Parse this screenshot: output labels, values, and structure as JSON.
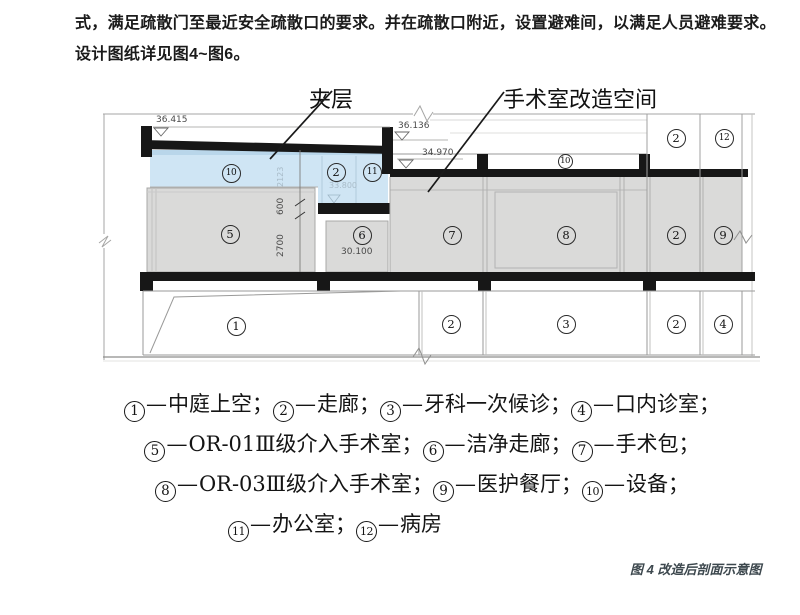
{
  "paragraph": {
    "line1": "式，满足疏散门至最近安全疏散口的要求。并在疏散口附近，设置避难间，以满足人员避难要求。",
    "line2": "设计图纸详见图4~图6。"
  },
  "figure": {
    "callouts": {
      "mezzanine": "夹层",
      "renovation": "手术室改造空间"
    },
    "colors": {
      "mezzanine_blue": "#cfe5f4",
      "mezzanine_blue_dark": "#b9d6ea",
      "room_gray": "#dadad9",
      "structure_black": "#171717",
      "outline_gray": "#9a9a99"
    },
    "room_labels": [
      {
        "n": "10",
        "cx": 231,
        "cy": 173
      },
      {
        "n": "2",
        "cx": 336,
        "cy": 172
      },
      {
        "n": "11",
        "cx": 372,
        "cy": 172
      },
      {
        "n": "5",
        "cx": 230,
        "cy": 234
      },
      {
        "n": "6",
        "cx": 362,
        "cy": 235
      },
      {
        "n": "10",
        "cx": 565,
        "cy": 161,
        "small": true
      },
      {
        "n": "2",
        "cx": 676,
        "cy": 138
      },
      {
        "n": "12",
        "cx": 724,
        "cy": 138
      },
      {
        "n": "7",
        "cx": 452,
        "cy": 235
      },
      {
        "n": "8",
        "cx": 566,
        "cy": 235
      },
      {
        "n": "2",
        "cx": 676,
        "cy": 235
      },
      {
        "n": "9",
        "cx": 723,
        "cy": 235
      },
      {
        "n": "1",
        "cx": 236,
        "cy": 326
      },
      {
        "n": "2",
        "cx": 451,
        "cy": 324
      },
      {
        "n": "3",
        "cx": 566,
        "cy": 324
      },
      {
        "n": "2",
        "cx": 676,
        "cy": 324
      },
      {
        "n": "4",
        "cx": 723,
        "cy": 324
      }
    ],
    "annotations": [
      {
        "text": "36.415",
        "x": 156,
        "y": 115,
        "size": 9
      },
      {
        "text": "36.136",
        "x": 398,
        "y": 121,
        "size": 9
      },
      {
        "text": "34.970",
        "x": 422,
        "y": 148,
        "size": 9
      },
      {
        "text": "33.800",
        "x": 329,
        "y": 181,
        "size": 8,
        "muted": true
      },
      {
        "text": "30.100",
        "x": 341,
        "y": 247,
        "size": 9
      },
      {
        "text": "2123",
        "x": 287,
        "y": 187,
        "size": 8,
        "rot": true,
        "muted": true
      },
      {
        "text": "600",
        "x": 287,
        "y": 215,
        "size": 9,
        "rot": true
      },
      {
        "text": "2700",
        "x": 287,
        "y": 257,
        "size": 9,
        "rot": true
      }
    ]
  },
  "legend": {
    "dash": "—",
    "separator": "；",
    "lines": [
      [
        {
          "n": "1",
          "label": "中庭上空"
        },
        {
          "n": "2",
          "label": "走廊"
        },
        {
          "n": "3",
          "label": "牙科一次候诊"
        },
        {
          "n": "4",
          "label": "口内诊室"
        }
      ],
      [
        {
          "n": "5",
          "label": "OR-01Ⅲ级介入手术室"
        },
        {
          "n": "6",
          "label": "洁净走廊"
        },
        {
          "n": "7",
          "label": "手术包"
        }
      ],
      [
        {
          "n": "8",
          "label": "OR-03Ⅲ级介入手术室"
        },
        {
          "n": "9",
          "label": "医护餐厅"
        },
        {
          "n": "10",
          "label": "设备"
        }
      ],
      [
        {
          "n": "11",
          "label": "办公室"
        },
        {
          "n": "12",
          "label": "病房",
          "no_separator": true
        }
      ]
    ]
  },
  "caption": {
    "text": "图 4 改造后剖面示意图",
    "color": "#3d484e"
  }
}
